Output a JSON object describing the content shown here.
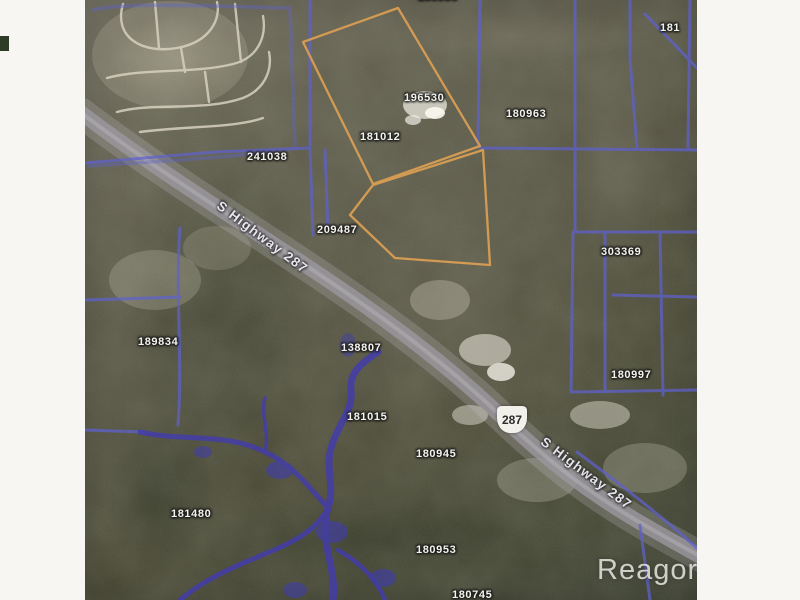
{
  "map": {
    "parcel_labels": [
      {
        "id": "180980"
      },
      {
        "id": "181"
      },
      {
        "id": "196530"
      },
      {
        "id": "180963"
      },
      {
        "id": "181012"
      },
      {
        "id": "241038"
      },
      {
        "id": "209487"
      },
      {
        "id": "303369"
      },
      {
        "id": "189834"
      },
      {
        "id": "138807"
      },
      {
        "id": "180997"
      },
      {
        "id": "181015"
      },
      {
        "id": "180945"
      },
      {
        "id": "181480"
      },
      {
        "id": "180953"
      },
      {
        "id": "180745"
      }
    ],
    "highway": {
      "shield": "287",
      "name": "S Highway 287"
    },
    "place": {
      "name": "Reagor"
    },
    "colors": {
      "subject_parcel_orange": "#dc9a4a",
      "parcel_line_blue": "#5a5ed8",
      "creek_blue": "#4038b8",
      "road_gray": "#98959e"
    }
  }
}
